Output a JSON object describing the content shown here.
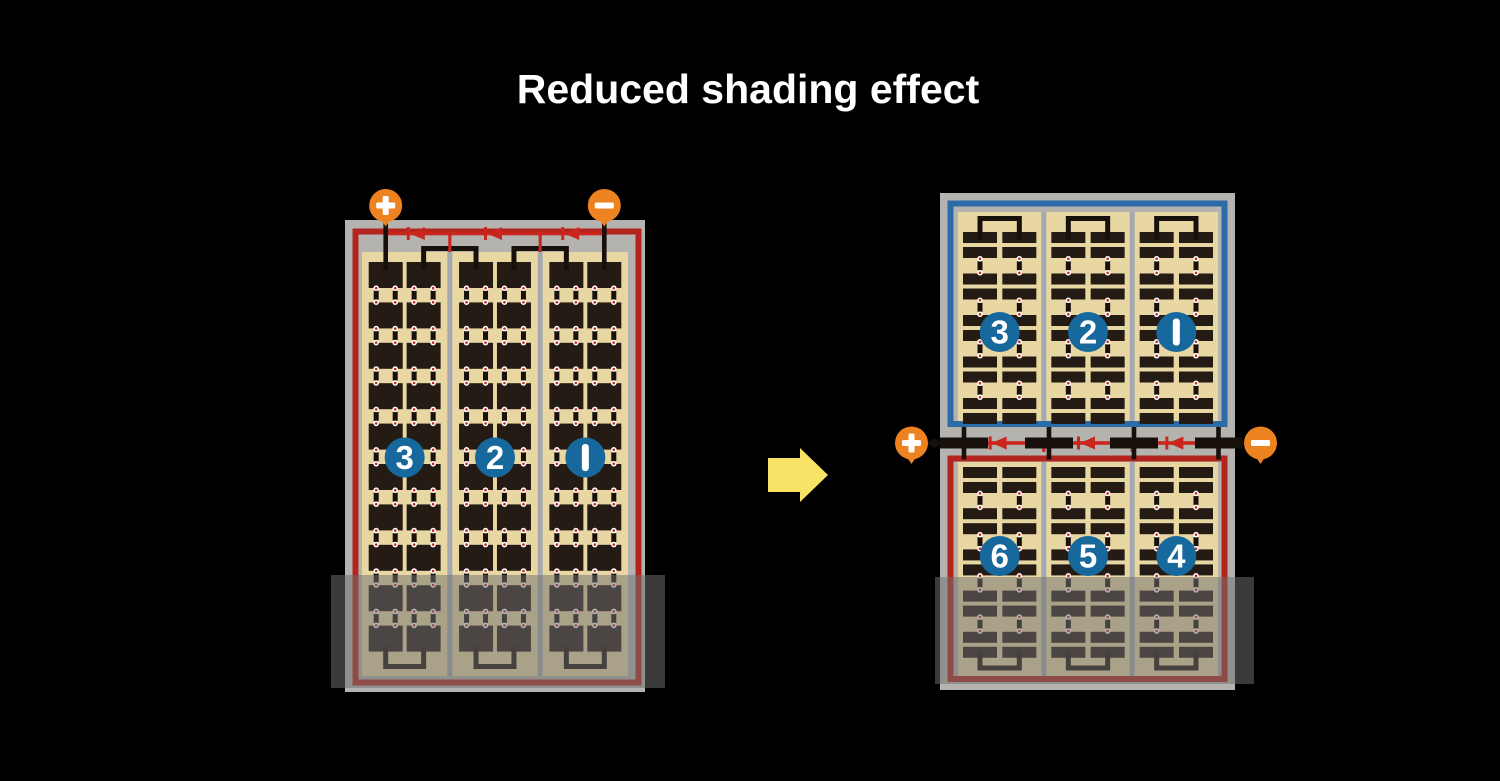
{
  "title": "Reduced shading effect",
  "colors": {
    "background": "#000000",
    "title_text": "#ffffff",
    "frame_gray": "#b5b3b0",
    "separator_gray": "#a3a9ae",
    "cell_area_tan": "#e8d7a3",
    "cell_dark": "#241b14",
    "wire_black": "#17100b",
    "border_red": "#b2241d",
    "bus_red": "#c9261d",
    "border_blue": "#2b6ba8",
    "badge_blue": "#16689d",
    "badge_text": "#ffffff",
    "terminal_orange": "#ed8320",
    "terminal_glyph": "#ffffff",
    "dot_red": "#c9261d",
    "dot_white": "#ffffff",
    "arrow_yellow": "#f8e366",
    "shading_overlay": "rgba(112,112,112,0.52)"
  },
  "left_panel": {
    "plus_symbol": "+",
    "minus_symbol": "−",
    "string_badges": [
      "3",
      "2",
      "1"
    ],
    "strings": 3,
    "cell_rows": 10,
    "cell_columns_per_string": 2,
    "bypass_diodes": 3,
    "shaded_region": true
  },
  "right_panel": {
    "plus_symbol": "+",
    "minus_symbol": "−",
    "top_half": {
      "string_badges": [
        "3",
        "2",
        "1"
      ],
      "cell_pair_rows": 5
    },
    "bottom_half": {
      "string_badges": [
        "6",
        "5",
        "4"
      ],
      "cell_pair_rows": 5
    },
    "bypass_diodes": 3,
    "shaded_region": true
  },
  "arrow": {
    "direction": "right"
  }
}
